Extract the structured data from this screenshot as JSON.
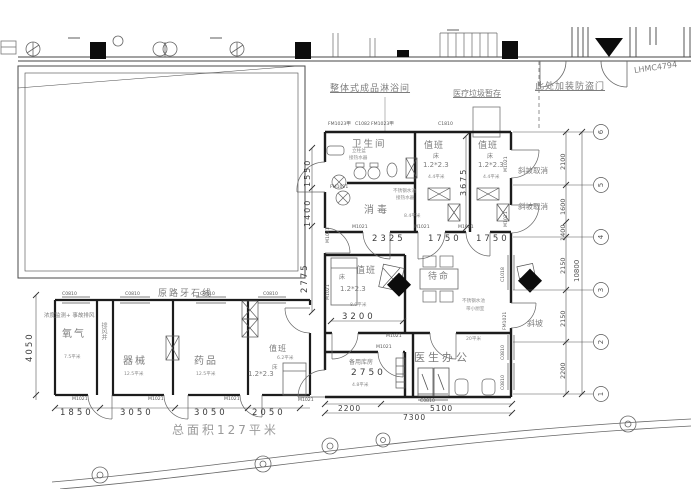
{
  "annotations": {
    "shower_unit": "整体式成品淋浴间",
    "medical_waste_storage": "医疗垃圾暂存",
    "security_door_note": "此处加装防盗门",
    "door_model": "LHMC4794",
    "curb_line": "原路牙石线",
    "monitoring_note": "浓度监测+ 事故排风",
    "slope_cancelled": "斜坡取消",
    "slope": "斜坡",
    "total_area": "总面积127平米",
    "pedestal_basin": "立柱盆",
    "connect_heater": "接热水器",
    "ss_sink": "不锈钢水池",
    "kitchenette": "带小厨室"
  },
  "rooms": {
    "toilet": "卫生间",
    "duty": "值班",
    "disinfection": "消毒",
    "standby": "待命",
    "spare_storage": "备用库房",
    "doctor_office": "医生办公",
    "oxygen": "氧气",
    "instruments": "器械",
    "medicine": "药品",
    "exhaust_shaft": "排风井",
    "bed": "床",
    "bed_size": "1.2*2.3"
  },
  "areas": {
    "a75": "7.5平米",
    "a125": "12.5平米",
    "a62": "6.2平米",
    "a48": "4.8平米",
    "a84": "8.4平米",
    "a89": "8.9平米",
    "a44": "4.4平米",
    "a20": "20平米"
  },
  "codes": {
    "m1021": "M1021",
    "fm1021": "FM1021",
    "fm1023": "FM1023甲",
    "c1082": "C1082",
    "c1810": "C1810",
    "c0810": "C0810",
    "c1018": "C1018"
  },
  "dims": {
    "d1550": "1550",
    "d1400": "1400",
    "d2775": "2775",
    "d2325": "2325",
    "d1750": "1750",
    "d3675": "3675",
    "d3200": "3200",
    "d2750": "2750",
    "d2200": "2200",
    "d5100": "5100",
    "d7300": "7300",
    "d1850": "1850",
    "d3050": "3050",
    "d2050": "2050",
    "d4050": "4050",
    "d2100": "2100",
    "d1600": "1600",
    "d2150": "2150",
    "d10800": "10800"
  },
  "grid": {
    "b1": "1",
    "b2": "2",
    "b3": "3",
    "b4": "4",
    "b5": "5",
    "b6": "6"
  }
}
